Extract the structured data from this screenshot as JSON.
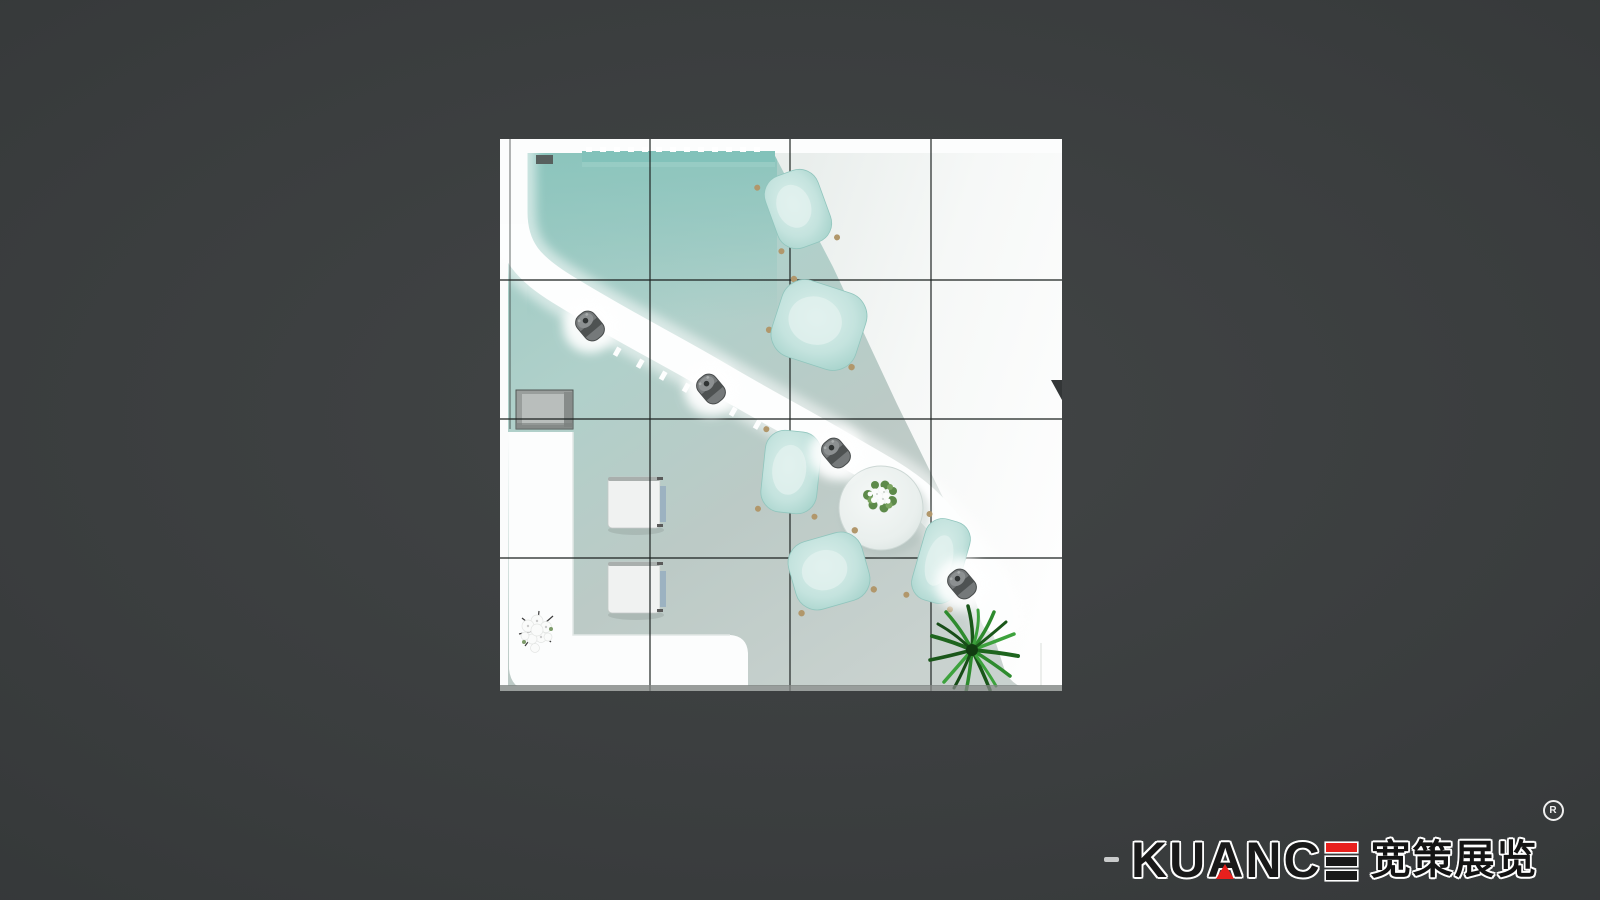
{
  "scene": {
    "description": "Top-down 3D render of an exhibition booth floor plan on a dark charcoal background",
    "grid": {
      "columns": 4,
      "rows": 4
    },
    "furniture": {
      "tea_chairs": 5,
      "bar_stools": 4,
      "cube_seats": 2,
      "round_tables": 1,
      "plants": 2,
      "cabinets": 1
    },
    "colors": {
      "background": "#383b3c",
      "floor_teal": "#9bcac3",
      "floor_gray": "#c8d2cf",
      "wall_white": "#fcfdfd",
      "chair_teal": "#c4e3de",
      "stool_gray": "#75797a",
      "plant_green": "#2d7f2d"
    }
  },
  "brand": {
    "dash": "-",
    "name": "KUANCE",
    "letters": [
      "K",
      "U",
      "A",
      "N",
      "C"
    ],
    "cjk": "宽策展览",
    "registered": "R",
    "accent_red": "#e8201d",
    "text_color": "#191919",
    "outline_color": "#ffffff"
  }
}
